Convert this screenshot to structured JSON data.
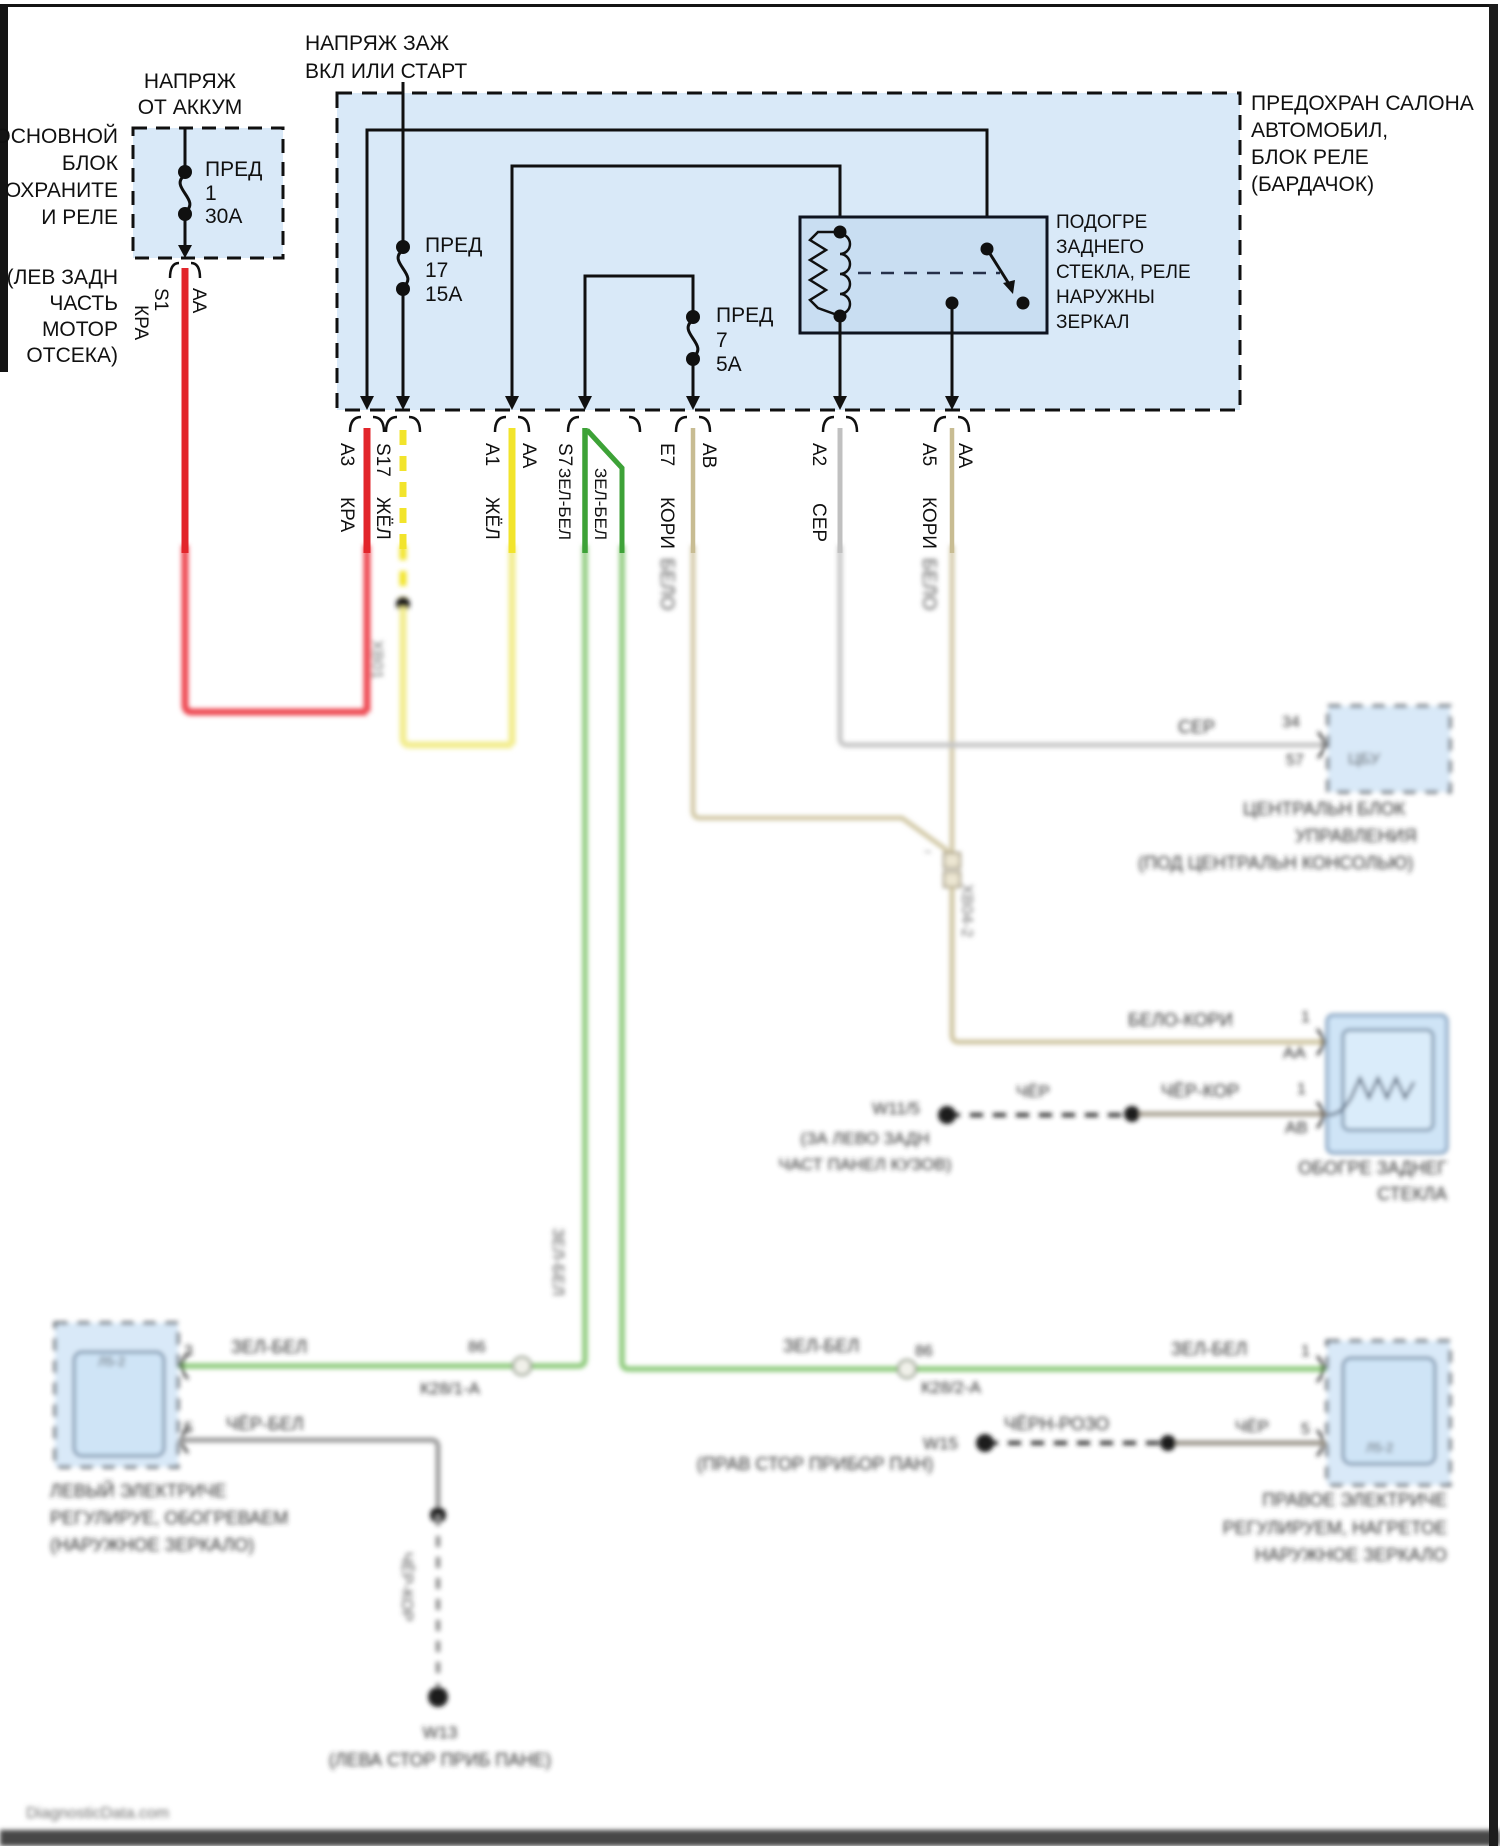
{
  "watermark": "DiagnosticData.com",
  "battery": {
    "title": [
      "НАПРЯЖ",
      "ОТ АККУМ"
    ],
    "block": [
      "ОСНОВНОЙ",
      "БЛОК",
      "ОХРАНИТЕ",
      "И РЕЛЕ"
    ],
    "loc": [
      "(ЛЕВ ЗАДН",
      "ЧАСТЬ",
      "МОТОР",
      "ОТСЕКА)"
    ],
    "fuse": [
      "ПРЕД",
      "1",
      "30А"
    ],
    "pin": "S1",
    "pin_wire": "AA",
    "color": "КРА"
  },
  "ign": {
    "title": [
      "НАПРЯЖ ЗАЖ",
      "ВКЛ ИЛИ СТАРТ"
    ]
  },
  "ibox": {
    "name": [
      "ПРЕДОХРАН САЛОНА",
      "АВТОМОБИЛ,",
      "БЛОК РЕЛЕ",
      "(БАРДАЧОК)"
    ],
    "fuse17": [
      "ПРЕД",
      "17",
      "15А"
    ],
    "fuse7": [
      "ПРЕД",
      "7",
      "5А"
    ],
    "relay": [
      "ПОДОГРЕ",
      "ЗАДНЕГО",
      "СТЕКЛА, РЕЛЕ",
      "НАРУЖНЫ",
      "ЗЕРКАЛ"
    ]
  },
  "pins": {
    "a3": "A3",
    "s17": "S17",
    "a1": "A1",
    "aa1": "AA",
    "s7": "S7",
    "e7": "E7",
    "ab": "AB",
    "a2": "A2",
    "a5": "A5",
    "aa2": "AA"
  },
  "colors": {
    "kra": "КРА",
    "zhel": "ЖЁЛ",
    "zelbel": "ЗЕЛ-БЕЛ",
    "kori": "КОРИ",
    "ser": "СЕР",
    "belo": "БЕЛО",
    "belokori": "БЕЛО-КОРИ",
    "cherkor": "ЧЁР-КОР",
    "cher": "ЧЁР",
    "cherbel": "ЧЁР-БЕЛ",
    "chernrozo": "ЧЁРН-РОЗО"
  },
  "conn": {
    "xb01": "ХВ01",
    "xb042": "ХВ04-2",
    "k281": "К28/1-А",
    "k282": "К28/2-А",
    "p86": "86",
    "tilde": "~"
  },
  "ccu": {
    "pin": "34",
    "pin2": "57",
    "inner": "ЦБУ",
    "label": [
      "ЦЕНТРАЛЬН БЛОК",
      "УПРАВЛЕНИЯ",
      "(ПОД ЦЕНТРАЛЬН КОНСОЛЬЮ)"
    ]
  },
  "rw": {
    "p1": "1",
    "aa": "AA",
    "p2": "1",
    "ab": "AB",
    "gnd": "W11/5",
    "gnd_loc": [
      "(ЗА ЛЕВО ЗАДН",
      "ЧАСТ ПАНЕЛ КУЗОВ)"
    ],
    "label": [
      "ОБОГРЕ ЗАДНЕГ",
      "СТЕКЛА"
    ]
  },
  "lm": {
    "p1": "3",
    "p2": "5",
    "inner": "Л5-2",
    "gnd": "W13",
    "gnd_loc": "(ЛЕВА СТОР ПРИБ ПАНЕ)",
    "label": [
      "ЛЕВЫЙ ЭЛЕКТРИЧЕ",
      "РЕГУЛИРУЕ, ОБОГРЕВАЕМ",
      "(НАРУЖНОЕ ЗЕРКАЛО)"
    ]
  },
  "rm": {
    "p1": "1",
    "p2": "5",
    "inner": "Л5-2",
    "gnd": "W15",
    "gnd_loc": "(ПРАВ СТОР ПРИБОР ПАН)",
    "label": [
      "ПРАВОЕ ЭЛЕКТРИЧЕ",
      "РЕГУЛИРУЕМ, НАГРЕТОЕ",
      "НАРУЖНОЕ ЗЕРКАЛО"
    ]
  }
}
